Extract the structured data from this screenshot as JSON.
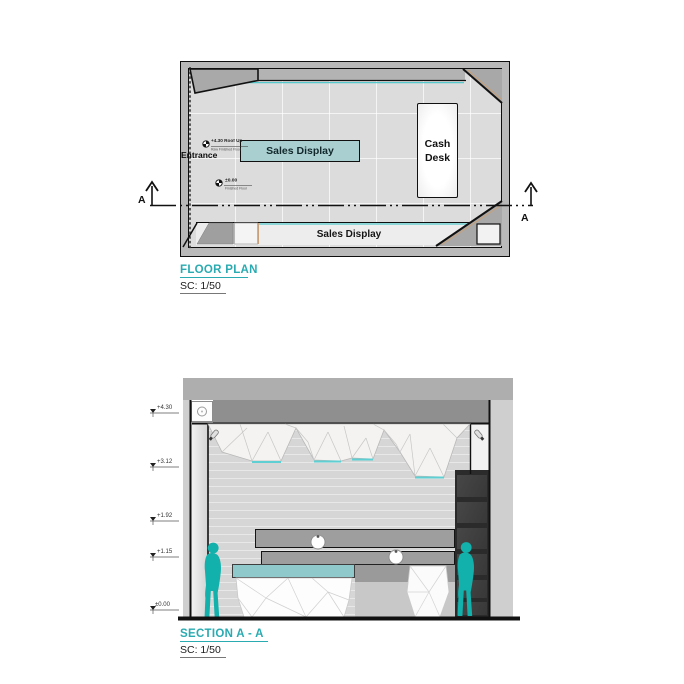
{
  "colors": {
    "accent_teal": "#29abb1",
    "display_fill": "#a9cfd1",
    "counter_top": "#90c9cb",
    "person": "#12b1ac",
    "wall_gray": "#b9b9b9",
    "dark_shelf": "#3f3f3f",
    "tan_accent": "#c9a077"
  },
  "floor_plan": {
    "title": "FLOOR PLAN",
    "scale_label": "SC: 1/50",
    "entrance_label": "Entrance",
    "center_display_label": "Sales Display",
    "bottom_display_label": "Sales Display",
    "cash_desk_line1": "Cash",
    "cash_desk_line2": "Desk",
    "marker_roof": {
      "value": "+4.30 Roof Up",
      "note": "Raw Finished Floor"
    },
    "marker_floor": {
      "value": "±0.00",
      "note": "Finished Floor"
    },
    "section_label_left": "A",
    "section_label_right": "A"
  },
  "section": {
    "title": "SECTION A - A",
    "scale_label": "SC: 1/50",
    "levels": [
      "+4.30",
      "+3.12",
      "+1.92",
      "+1.15",
      "±0.00"
    ]
  }
}
